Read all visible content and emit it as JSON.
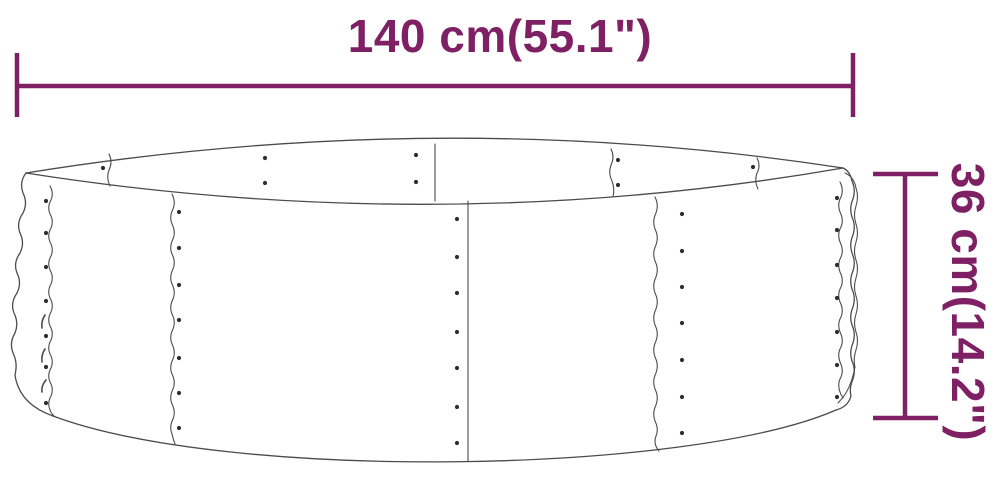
{
  "diagram": {
    "illustration": "round-metal-raised-garden-bed-line-drawing",
    "width_dimension": {
      "label": "140 cm(55.1\")"
    },
    "height_dimension": {
      "label": "36 cm(14.2\")"
    },
    "accent_color": "#7e2063",
    "sketch_line_color": "#4b4b4b",
    "background_color": "#ffffff"
  }
}
